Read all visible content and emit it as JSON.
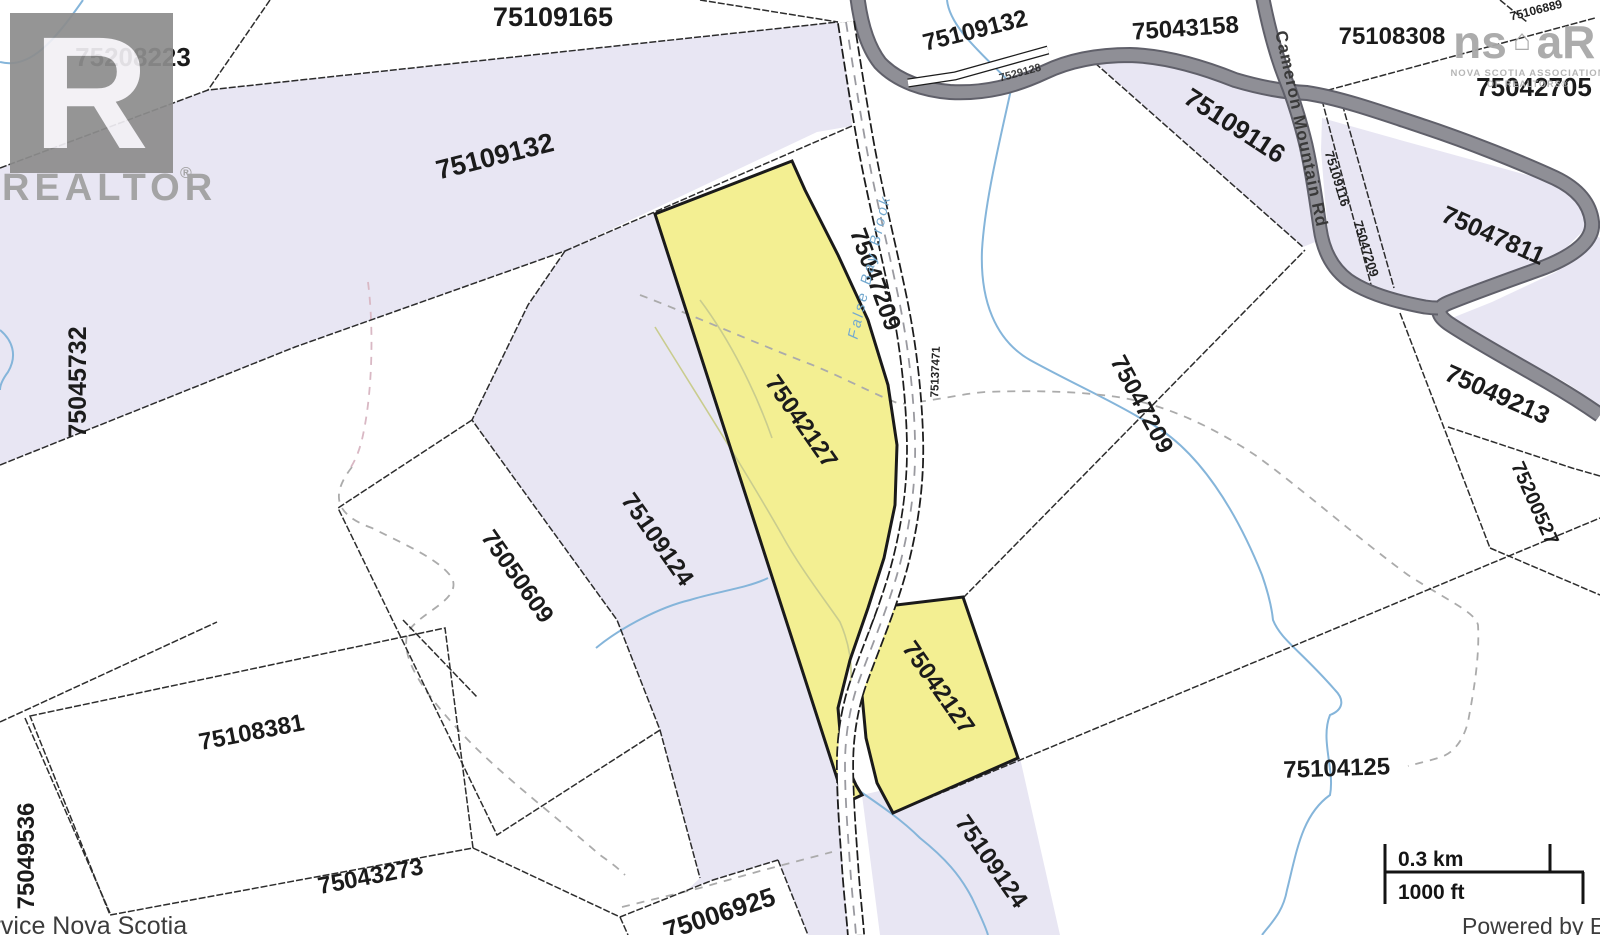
{
  "parcels": {
    "n75208223": "75208223",
    "n75109165": "75109165",
    "n75109132": "75109132",
    "n75043158": "75043158",
    "n75108308": "75108308",
    "n75042705": "75042705",
    "n75106889": "75106889",
    "n75109116": "75109116",
    "n75047811": "75047811",
    "n75049213": "75049213",
    "n75200527": "75200527",
    "n75045732": "75045732",
    "n75047209": "75047209",
    "n75042127": "75042127",
    "n75109124": "75109124",
    "n75050609": "75050609",
    "n75108381": "75108381",
    "n75049536": "75049536",
    "n75043273": "75043273",
    "n75104125": "75104125",
    "n75006925": "75006925",
    "n75137471": "75137471",
    "n7529128": "7529128"
  },
  "roads": {
    "cameron_mountain_rd": "Cameron Mountain Rd"
  },
  "water": {
    "brook": "False Bay Brook"
  },
  "scalebar": {
    "km": "0.3 km",
    "ft": "1000 ft"
  },
  "credits": {
    "left": "Service Nova Scotia",
    "right": "Powered by Esri"
  },
  "branding": {
    "realtor_letter": "R",
    "realtor_word": "REALTOR",
    "registered": "®",
    "nsar_ns": "ns",
    "nsar_house": "⌂",
    "nsar_ar": "aR",
    "nsar_sub1": "NOVA SCOTIA ASSOCIATION",
    "nsar_sub2": "OF REALTORS®"
  },
  "colors": {
    "highlight_yellow": "#f3ef92",
    "parcel_lavender": "#e8e6f3",
    "road_gray": "#8f8f96",
    "water_blue": "#85b5da"
  }
}
